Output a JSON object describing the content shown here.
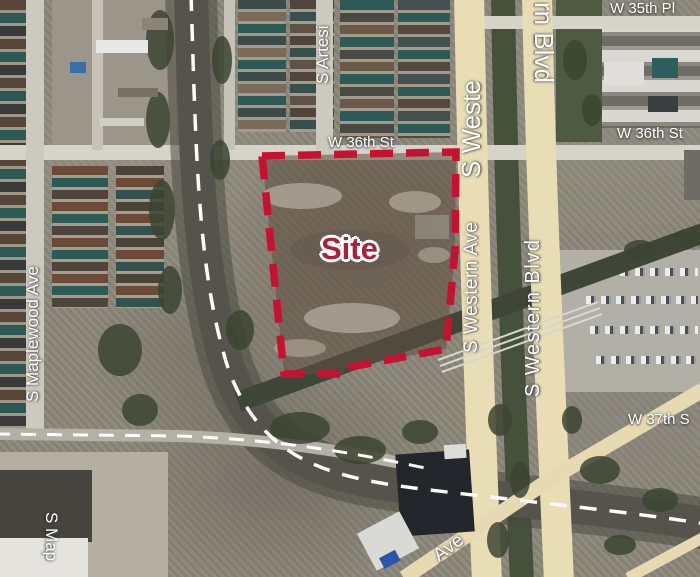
{
  "map": {
    "site_label": "Site",
    "labels": {
      "w35pl": "W 35th Pl",
      "w36_left": "W 36th St",
      "w36_right": "W 36th St",
      "w37": "W 37th S",
      "artesian_partial": "S Artesi",
      "western_upper_partial": "S Weste",
      "western_blvd_upper_partial": "rn Blvd",
      "western_ave": "S Western Ave",
      "western_blvd": "S Western Blvd",
      "maplewood": "S Maplewood Ave",
      "maplewood_lower_partial": "S Map",
      "ave_diagonal": "Ave"
    },
    "colors": {
      "site_boundary": "#c51230",
      "site_text": "#ad2038",
      "street_label_text": "#ffffff",
      "major_road": "#e9ddb6"
    }
  }
}
